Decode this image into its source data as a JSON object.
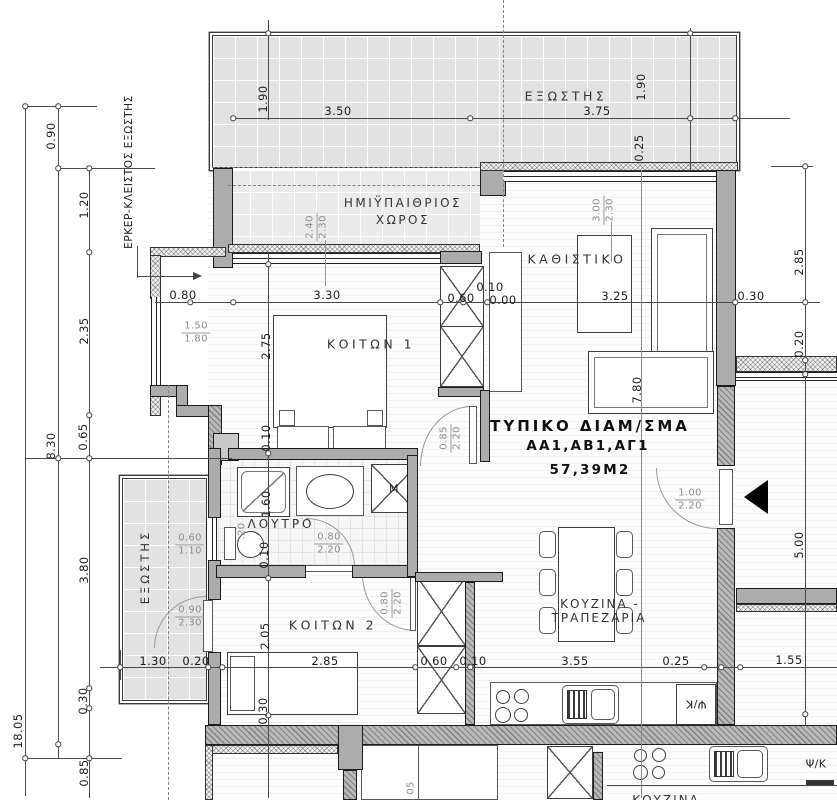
{
  "title": {
    "l1": "ΤΥΠΙΚΟ ΔΙΑΜ/ΣΜΑ",
    "l2": "ΑΑ1,ΑΒ1,ΑΓ1",
    "l3": "57,39Μ2"
  },
  "rooms": {
    "balcony_top": "ΕΞΩΣΤΗΣ",
    "semi1": "ΗΜΙΫΠΑΙΘΡΙΟΣ",
    "semi2": "ΧΩΡΟΣ",
    "living": "ΚΑΘΙΣΤΙΚΟ",
    "bedroom1": "ΚΟΙΤΩΝ 1",
    "bathroom": "ΛΟΥΤΡΟ",
    "balcony_left": "ΕΞΩΣΤΗΣ",
    "bedroom2": "ΚΟΙΤΩΝ 2",
    "kitchen1": "ΚΟΥΖΙΝΑ -",
    "kitchen2": "ΤΡΑΠΕΖΑΡΙΑ",
    "kitchen_below": "ΚΟΥΖΙΝΑ"
  },
  "ann": {
    "erker": "ΕΡΚΕΡ-ΚΛΕΙΣΤΟΣ ΕΞΩΣΤΗΣ",
    "washer": "Μ",
    "fridge": "Ψ/Κ",
    "fridge_below": "Ψ/Κ"
  },
  "dims": {
    "t190l": "1.90",
    "t350": "3.50",
    "t375": "3.75",
    "t190r": "1.90",
    "t025r": "0.25",
    "l090": "0.90",
    "l120": "1.20",
    "l235": "2.35",
    "l065": "0.65",
    "l830": "8.30",
    "l380": "3.80",
    "l030": "0.30",
    "l1805": "18.05",
    "l085": "0.85",
    "m080": "0.80",
    "m330": "3.30",
    "m060": "0.60",
    "m010": "0.10",
    "m000": "0.00",
    "m325": "3.25",
    "m030": "0.30",
    "r285": "2.85",
    "r020": "0.20",
    "r500": "5.00",
    "v275": "2.75",
    "v010a": "0.10",
    "v160": "1.60",
    "v020": ".20",
    "v010b": "0.10",
    "v205": "2.05",
    "v030": "0.30",
    "v780": "7.80",
    "b130": "1.30",
    "b020": "0.20",
    "b285": "2.85",
    "b060": "0.60",
    "b010": "0.10",
    "b355": "3.55",
    "b025": "0.25",
    "b155": "1.55",
    "low05": "05"
  },
  "fracs": {
    "f_bay": {
      "a": "1.50",
      "b": "1.80"
    },
    "f_bed1win": {
      "a": "2.40",
      "b": "2.30"
    },
    "f_livwin": {
      "a": "3.00",
      "b": "2.30"
    },
    "f_hall": {
      "a": "0.85",
      "b": "2.20"
    },
    "f_entry": {
      "a": "1.00",
      "b": "2.20"
    },
    "f_bath": {
      "a": "0.80",
      "b": "2.20"
    },
    "f_bed2": {
      "a": "0.80",
      "b": "2.20"
    },
    "f_balcwin": {
      "a": "0.60",
      "b": "1.10"
    },
    "f_balcdoor": {
      "a": "0.90",
      "b": "2.30"
    }
  },
  "colors": {
    "wall": "#ACACAC",
    "line": "#4A4A4A",
    "tile": "#E2E2E2",
    "entry_arrow": "#000000"
  }
}
